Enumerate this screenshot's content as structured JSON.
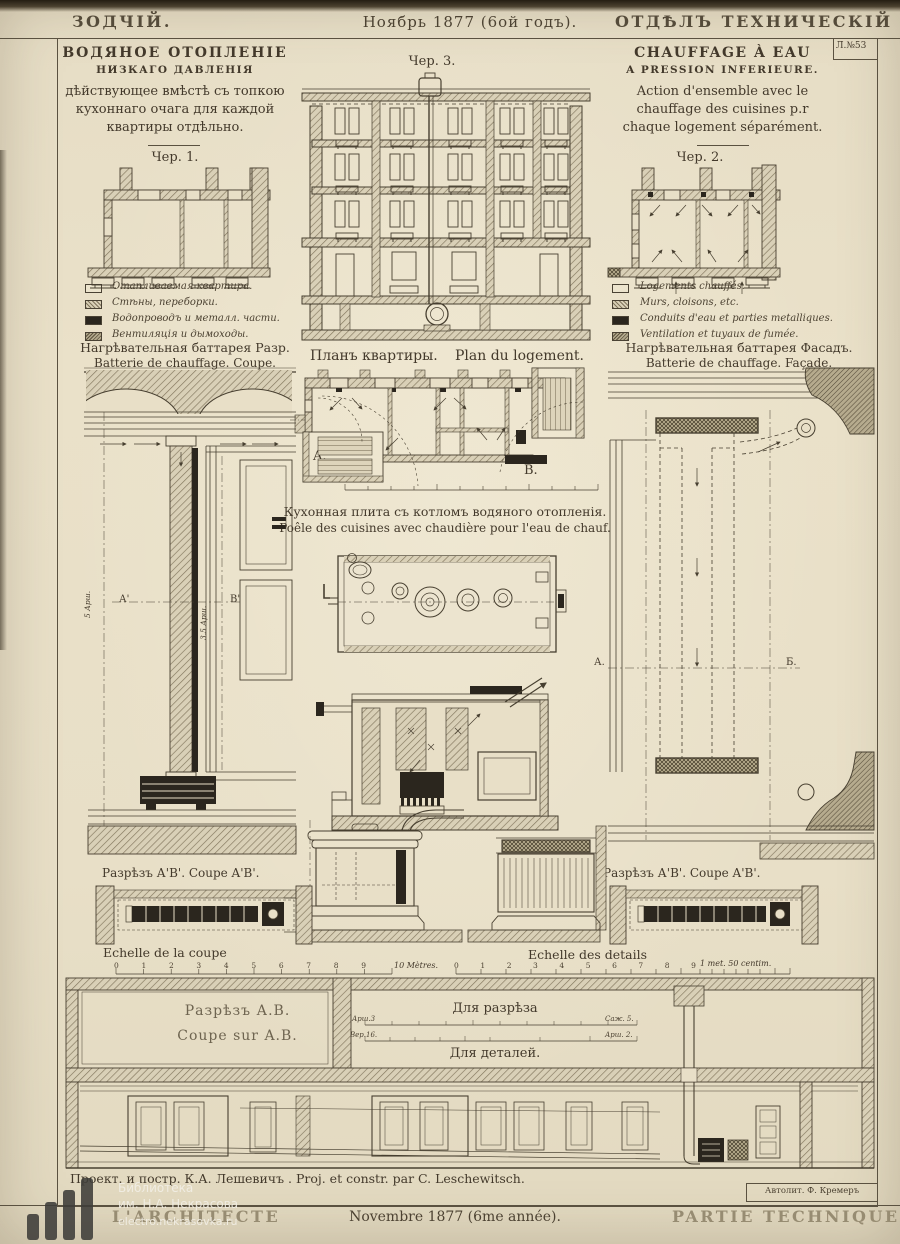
{
  "header": {
    "journal": "ЗОДЧІЙ.",
    "date": "Ноябрь 1877 (6ой годъ).",
    "section": "ОТДѢЛЪ ТЕХНИЧЕСКІЙ"
  },
  "plate_number": "Л.№53",
  "title_left": {
    "line1": "ВОДЯНОЕ ОТОПЛЕНІЕ",
    "line2": "НИЗКАГО ДАВЛЕНІЯ",
    "line3": "дѣйствующее вмѣстѣ съ топкою",
    "line4": "кухоннаго очага для каждой",
    "line5": "квартиры отдѣльно."
  },
  "title_right": {
    "line1": "CHAUFFAGE  À  EAU",
    "line2": "A PRESSION INFERIEURE.",
    "line3": "Action d'ensemble avec le",
    "line4": "chauffage des cuisines p.r",
    "line5": "chaque logement séparément."
  },
  "fig_captions": {
    "fig1": "Чер. 1.",
    "fig2": "Чер. 2.",
    "fig3": "Чер. 3."
  },
  "legend_left": {
    "items": [
      {
        "label": "Отапливаемая квартира."
      },
      {
        "label": "Стѣны, переборки."
      },
      {
        "label": "Водопроводъ и металл. части."
      },
      {
        "label": "Вентиляція и дымоходы."
      }
    ]
  },
  "legend_right": {
    "items": [
      {
        "label": "Logements chauffés."
      },
      {
        "label": "Murs, cloisons, etc."
      },
      {
        "label": "Conduits d'eau et parties metalliques."
      },
      {
        "label": "Ventilation et tuyaux de fumée."
      }
    ]
  },
  "section_titles": {
    "battery_coupe_ru": "Нагрѣвательная баттарея Разр.",
    "battery_coupe_fr": "Batterie de chauffage. Coupe.",
    "plan_ru": "Планъ квартиры.",
    "plan_fr": "Plan du logement.",
    "battery_facade_ru": "Нагрѣвательная баттарея Фасадъ.",
    "battery_facade_fr": "Batterie de chauffage. Façade.",
    "kitchen_ru": "Кухонная плита съ котломъ водяного отопленія.",
    "kitchen_fr": "Poêle des cuisines avec chaudière pour l'eau de chauf.",
    "coupe_ab_left": "Разрѣзъ А'В'. Coupe A'B'.",
    "coupe_ab_right": "Разрѣзъ А'В'. Coupe A'B'."
  },
  "scales": {
    "coupe_label": "Echelle de la coupe",
    "coupe_ticks": "0 1 2 3 4 5 6 7 8 9",
    "coupe_unit": "10 Mètres.",
    "details_label": "Echelle des details",
    "details_ticks": "0 1 2 3 4 5 6 7 8 9",
    "details_unit": "1 met. 50 centim."
  },
  "bottom": {
    "coupe_ru": "Разрѣзъ А.В.",
    "coupe_fr": "Coupe sur A.B.",
    "for_section": "Для разрѣза",
    "for_details": "Для деталей.",
    "end_top_left": "Арш.3",
    "end_top_right": "Саж. 5.",
    "end_bot_left": "Вер.16.",
    "end_bot_right": "Арш. 2."
  },
  "markers": {
    "a_prime": "А'",
    "b_prime": "В'",
    "plan_a": "A.",
    "plan_b": "B.",
    "facade_a": "А.",
    "facade_b": "Б."
  },
  "dims": {
    "left_v1": "5 Арш.",
    "left_v2": "3.5 Арш."
  },
  "credit": "Проект. и постр. К.А. Лешевичъ . Proj. et constr. par C. Leschewitsch.",
  "lithographer": "Автолит. Ф. Кремеръ",
  "footer": {
    "left": "L'ARCHITECTE",
    "center": "Novembre 1877 (6me année).",
    "right": "PARTIE TECHNIQUE"
  },
  "watermark": {
    "line1": "Библиотека",
    "line2": "им. Н.А. Некрасова",
    "line3": "electro.nekrasovka.ru"
  },
  "colors": {
    "paper": "#e8dfc7",
    "ink": "#43392b",
    "hatch": "#82765d",
    "dark": "#2b261e"
  }
}
